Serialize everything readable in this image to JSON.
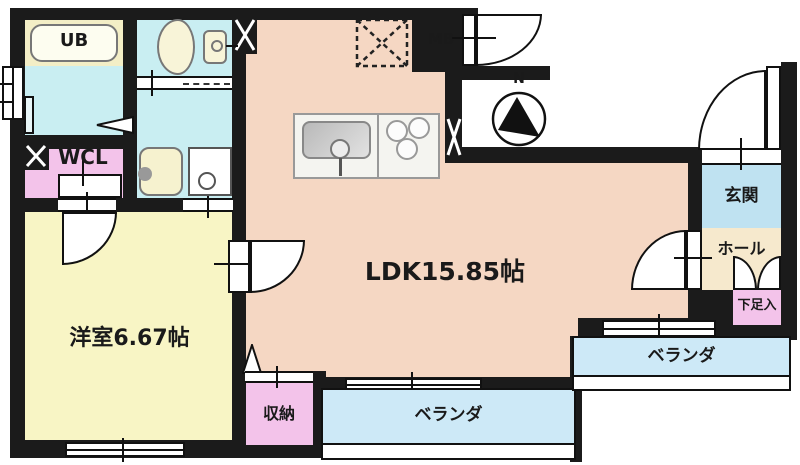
{
  "rooms": {
    "ub": "UB",
    "wcl": "WCL",
    "western": "洋室6.67帖",
    "ldk": "LDK15.85帖",
    "mb": "MB",
    "genkan": "玄関",
    "hall": "ホール",
    "shoe": "下足入",
    "storage": "収納",
    "veranda_south": "ベランダ",
    "veranda_east": "ベランダ"
  },
  "compass": {
    "north": "N"
  },
  "colors": {
    "wall": "#1b1b1b",
    "ldk": "#f5d7c3",
    "western_room": "#f8f5c5",
    "wet_area": "#c9eef2",
    "closet_pink": "#f3c3ea",
    "entrance": "#bfe2f1",
    "hall": "#f6e9cd",
    "veranda": "#cde9f7",
    "meter_box": "#c8d5e8",
    "fixture_yellow": "#f6f2cf"
  }
}
